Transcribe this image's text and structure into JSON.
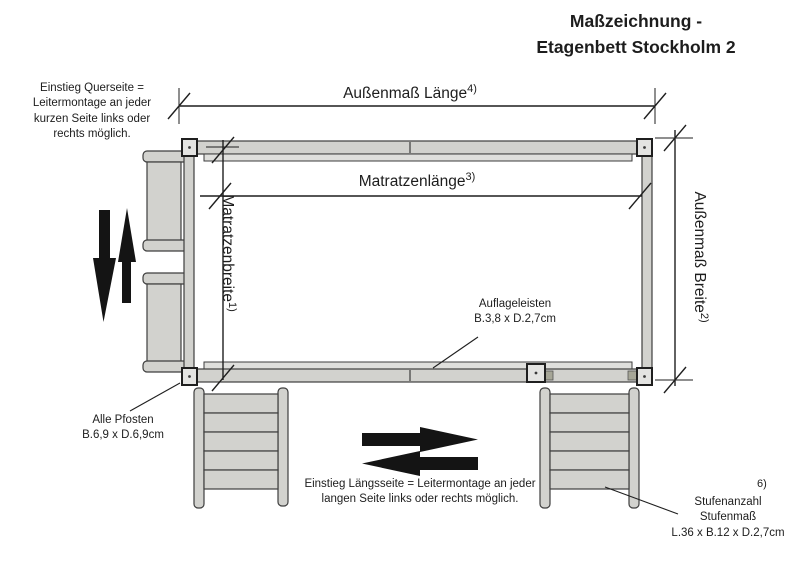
{
  "title": {
    "line1": "Maßzeichnung -",
    "line2": "Etagenbett Stockholm 2"
  },
  "dimensions": {
    "outer_length": {
      "label": "Außenmaß Länge",
      "footnote": "4)"
    },
    "outer_width": {
      "label": "Außenmaß Breite",
      "footnote": "2)"
    },
    "mattress_length": {
      "label": "Matratzenlänge",
      "footnote": "3)"
    },
    "mattress_width": {
      "label": "Matratzenbreite",
      "footnote": "1)"
    }
  },
  "notes": {
    "entry_short_side": "Einstieg Querseite =\nLeitermontage an jeder\nkurzen Seite links oder\nrechts möglich.",
    "entry_long_side": "Einstieg Längsseite = Leitermontage an jeder\nlangen Seite links oder rechts möglich.",
    "posts": "Alle Pfosten\nB.6,9 x D.6,9cm",
    "support_rails": "Auflageleisten\nB.3,8 x D.2,7cm",
    "steps": "Stufenanzahl\nStufenmaß\nL.36 x B.12 x D.2,7cm",
    "steps_footnote": "6)"
  },
  "icons": {
    "left_side": [
      "arrow-down-icon",
      "arrow-up-icon"
    ],
    "bottom_side": [
      "arrow-right-icon",
      "arrow-left-icon"
    ]
  },
  "colors": {
    "wood_fill": "#d2d2ce",
    "wood_light": "#dfdfdc",
    "post_fill": "#e4e4e2",
    "connector": "#a6a697",
    "line": "#1f1f1f",
    "stroke": "#3e3e3e",
    "arrow": "#141414"
  }
}
